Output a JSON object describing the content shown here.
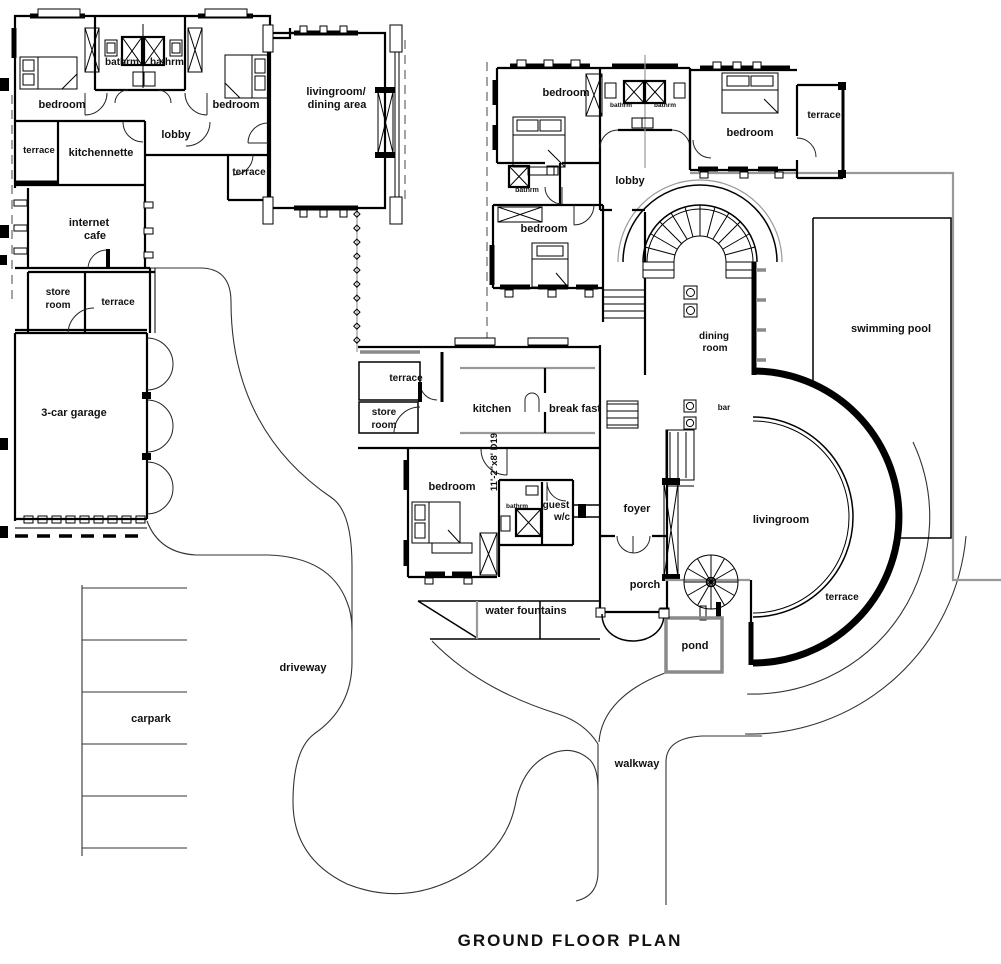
{
  "title": "GROUND FLOOR PLAN",
  "labels": {
    "bedroom": "bedroom",
    "bathrm": "bathrm",
    "lobby": "lobby",
    "terrace": "terrace",
    "kitchennette": "kitchennette",
    "internet_line1": "internet",
    "internet_line2": "cafe",
    "store_line1": "store",
    "store_line2": "room",
    "garage": "3-car garage",
    "lrda_line1": "livingroom/",
    "lrda_line2": "dining area",
    "dining_line1": "dining",
    "dining_line2": "room",
    "swimming_pool": "swimming pool",
    "kitchen": "kitchen",
    "break_fast": "break fast",
    "bar": "bar",
    "guest_line1": "guest",
    "guest_line2": "w/c",
    "foyer": "foyer",
    "livingroom": "livingroom",
    "porch": "porch",
    "water_fountains": "water fountains",
    "pond": "pond",
    "driveway": "driveway",
    "carpark": "carpark",
    "walkway": "walkway",
    "dim_note": "11'-2\"x8' D19"
  },
  "colors": {
    "wall": "#000000",
    "secondary": "#999999",
    "label": "#111111"
  }
}
